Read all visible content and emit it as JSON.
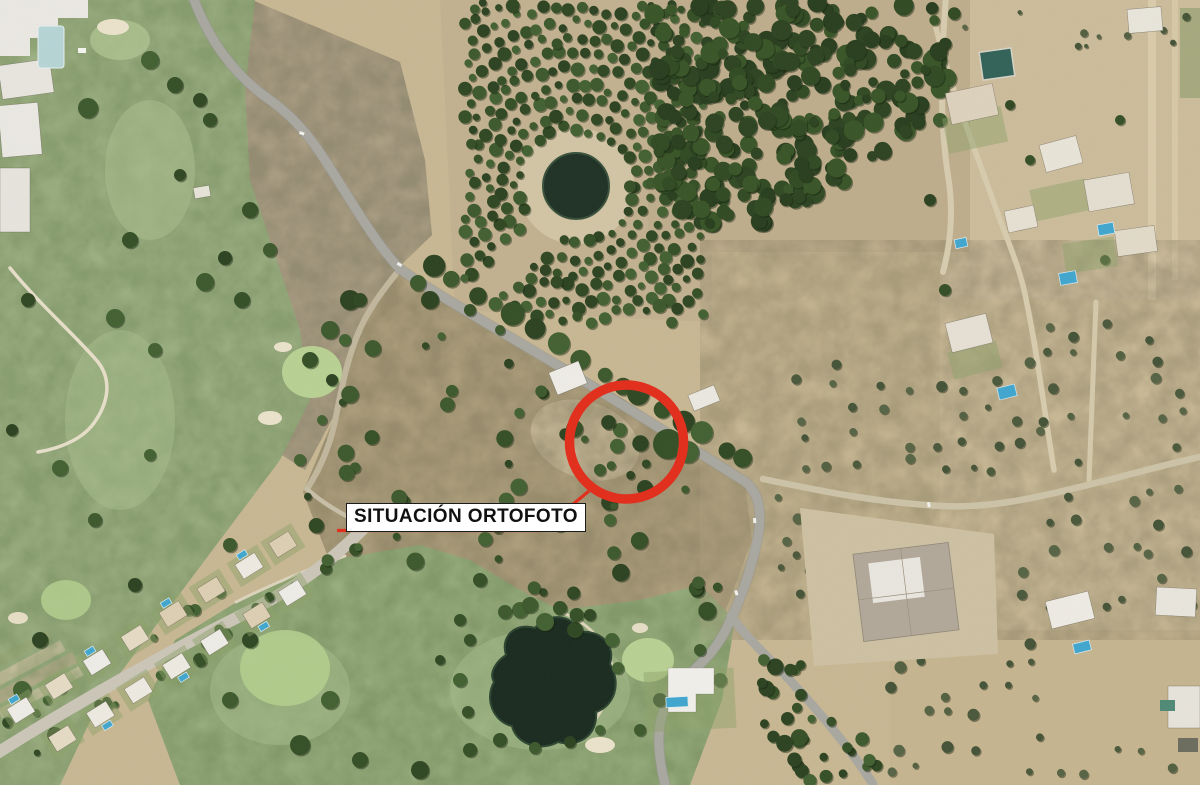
{
  "annotation": {
    "label": "SITUACIÓN ORTOFOTO",
    "circle_color": "#e2301f",
    "leader_color": "#e2301f",
    "label_background": "#ffffff",
    "label_text_color": "#111111"
  },
  "colors": {
    "terrain_beige": "#c9b893",
    "scrub_brown": "#b2a27f",
    "golf_green": "#9eb284",
    "bright_green": "#b9d293",
    "tree_dark": "#334e25",
    "water_dark": "#18291e",
    "pool_blue": "#3fa7d0",
    "reservoir_teal": "#2f6157",
    "road_gray": "#a9a8a1",
    "track_cream": "#d5caab",
    "building_white": "#eeece5",
    "annotation_red": "#e2301f"
  }
}
